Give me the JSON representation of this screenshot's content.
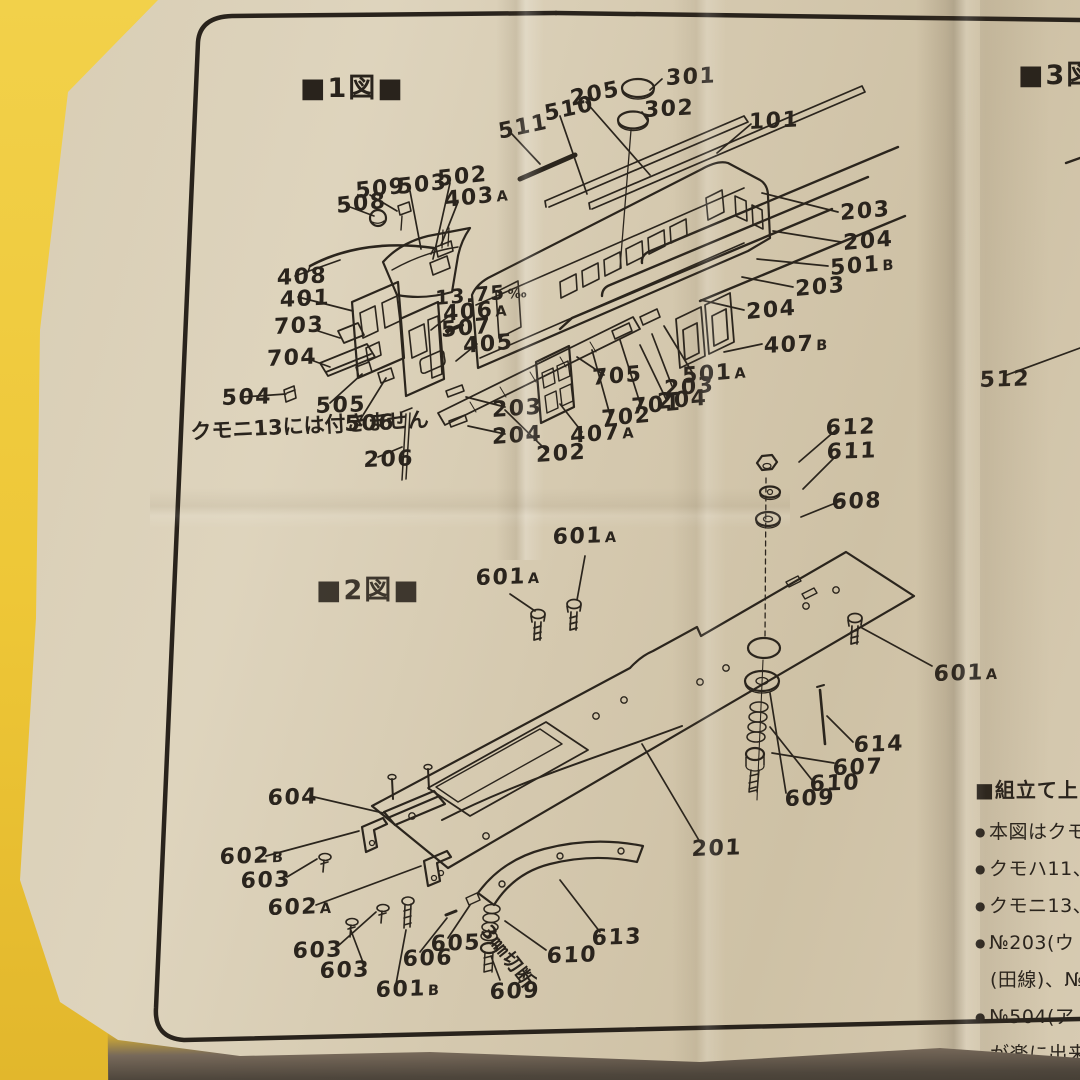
{
  "colors": {
    "background_yellow": "#eec737",
    "paper_tan": "#d8cdb4",
    "ink": "#2a241d"
  },
  "figures": {
    "fig1": "■1図■",
    "fig2": "■2図■",
    "fig3": "■3図"
  },
  "notes": {
    "kumoni": "クモニ13には付きません",
    "cut": "3㎜切断"
  },
  "part_labels": [
    {
      "t": "511",
      "x": 497,
      "y": 122,
      "r": -12
    },
    {
      "t": "510",
      "x": 543,
      "y": 104,
      "r": -12
    },
    {
      "t": "205",
      "x": 569,
      "y": 89,
      "r": -12
    },
    {
      "t": "301",
      "x": 666,
      "y": 68,
      "r": -3
    },
    {
      "t": "302",
      "x": 644,
      "y": 100,
      "r": -3
    },
    {
      "t": "101",
      "x": 749,
      "y": 112,
      "r": -3
    },
    {
      "t": "508",
      "x": 336,
      "y": 196,
      "r": -6
    },
    {
      "t": "509",
      "x": 355,
      "y": 181,
      "r": -6
    },
    {
      "t": "503",
      "x": 397,
      "y": 177,
      "r": -6
    },
    {
      "t": "502",
      "x": 437,
      "y": 169,
      "r": -6
    },
    {
      "t": "403",
      "s": "A",
      "x": 444,
      "y": 190,
      "r": -6
    },
    {
      "t": "203",
      "x": 840,
      "y": 203,
      "r": -5
    },
    {
      "t": "204",
      "x": 843,
      "y": 233,
      "r": -5
    },
    {
      "t": "501",
      "s": "B",
      "x": 830,
      "y": 258,
      "r": -5
    },
    {
      "t": "203",
      "x": 795,
      "y": 279,
      "r": -5
    },
    {
      "t": "408",
      "x": 277,
      "y": 268,
      "r": -3
    },
    {
      "t": "401",
      "x": 280,
      "y": 290,
      "r": -3
    },
    {
      "t": "13.75",
      "s": "‰",
      "x": 435,
      "y": 288,
      "r": -5,
      "fs": 20
    },
    {
      "t": "406",
      "s": "A",
      "x": 443,
      "y": 304,
      "r": -5
    },
    {
      "t": "507",
      "x": 441,
      "y": 320,
      "r": -5
    },
    {
      "t": "703",
      "x": 274,
      "y": 317,
      "r": -3
    },
    {
      "t": "405",
      "x": 463,
      "y": 336,
      "r": -5
    },
    {
      "t": "704",
      "x": 267,
      "y": 349,
      "r": -3
    },
    {
      "t": "407",
      "s": "B",
      "x": 764,
      "y": 336,
      "r": -3
    },
    {
      "t": "204",
      "x": 746,
      "y": 302,
      "r": -5
    },
    {
      "t": "504",
      "x": 222,
      "y": 388,
      "r": -2
    },
    {
      "t": "505",
      "x": 316,
      "y": 396,
      "r": -2
    },
    {
      "t": "506",
      "x": 345,
      "y": 414,
      "r": -2
    },
    {
      "t": "203",
      "x": 492,
      "y": 400,
      "r": -4
    },
    {
      "t": "204",
      "x": 492,
      "y": 427,
      "r": -4
    },
    {
      "t": "705",
      "x": 592,
      "y": 368,
      "r": -5
    },
    {
      "t": "501",
      "s": "A",
      "x": 682,
      "y": 366,
      "r": -5
    },
    {
      "t": "203",
      "x": 664,
      "y": 379,
      "r": -5
    },
    {
      "t": "204",
      "x": 657,
      "y": 392,
      "r": -5
    },
    {
      "t": "701",
      "x": 631,
      "y": 397,
      "r": -5
    },
    {
      "t": "702",
      "x": 601,
      "y": 409,
      "r": -5
    },
    {
      "t": "407",
      "s": "A",
      "x": 570,
      "y": 426,
      "r": -5
    },
    {
      "t": "202",
      "x": 536,
      "y": 445,
      "r": -4
    },
    {
      "t": "206",
      "x": 364,
      "y": 450,
      "r": -2
    },
    {
      "t": "512",
      "x": 980,
      "y": 370,
      "r": -2
    },
    {
      "t": "612",
      "x": 826,
      "y": 418,
      "r": -2
    },
    {
      "t": "611",
      "x": 827,
      "y": 442,
      "r": -2
    },
    {
      "t": "608",
      "x": 832,
      "y": 492,
      "r": -2
    },
    {
      "t": "601",
      "s": "A",
      "x": 553,
      "y": 527,
      "r": -2
    },
    {
      "t": "601",
      "s": "A",
      "x": 476,
      "y": 568,
      "r": -2
    },
    {
      "t": "601",
      "s": "A",
      "x": 934,
      "y": 664,
      "r": -2
    },
    {
      "t": "614",
      "x": 854,
      "y": 735,
      "r": -2
    },
    {
      "t": "607",
      "x": 833,
      "y": 758,
      "r": -2
    },
    {
      "t": "610",
      "x": 810,
      "y": 774,
      "r": -2
    },
    {
      "t": "609",
      "x": 785,
      "y": 789,
      "r": -2
    },
    {
      "t": "604",
      "x": 268,
      "y": 788,
      "r": -2
    },
    {
      "t": "602",
      "s": "B",
      "x": 220,
      "y": 847,
      "r": -2
    },
    {
      "t": "603",
      "x": 241,
      "y": 871,
      "r": -2
    },
    {
      "t": "602",
      "s": "A",
      "x": 268,
      "y": 898,
      "r": -2
    },
    {
      "t": "603",
      "x": 293,
      "y": 941,
      "r": -2
    },
    {
      "t": "603",
      "x": 320,
      "y": 961,
      "r": -2
    },
    {
      "t": "605",
      "x": 431,
      "y": 934,
      "r": -2
    },
    {
      "t": "606",
      "x": 403,
      "y": 949,
      "r": -2
    },
    {
      "t": "601",
      "s": "B",
      "x": 376,
      "y": 980,
      "r": -2
    },
    {
      "t": "610",
      "x": 547,
      "y": 946,
      "r": -2
    },
    {
      "t": "609",
      "x": 490,
      "y": 982,
      "r": -2
    },
    {
      "t": "613",
      "x": 592,
      "y": 928,
      "r": -2
    },
    {
      "t": "201",
      "x": 692,
      "y": 839,
      "r": -2
    }
  ],
  "side_panel": {
    "heading": "■組立て上の",
    "bullets": [
      {
        "b": 1,
        "t": "本図はクモニ"
      },
      {
        "b": 1,
        "t": "クモハ11、"
      },
      {
        "b": 1,
        "t": "クモニ13、"
      },
      {
        "b": 1,
        "t": "№203(ウ"
      },
      {
        "b": 0,
        "t": "(田線)、№"
      },
      {
        "b": 1,
        "t": "№504(ア"
      },
      {
        "b": 0,
        "t": "が楽に出来"
      }
    ]
  }
}
